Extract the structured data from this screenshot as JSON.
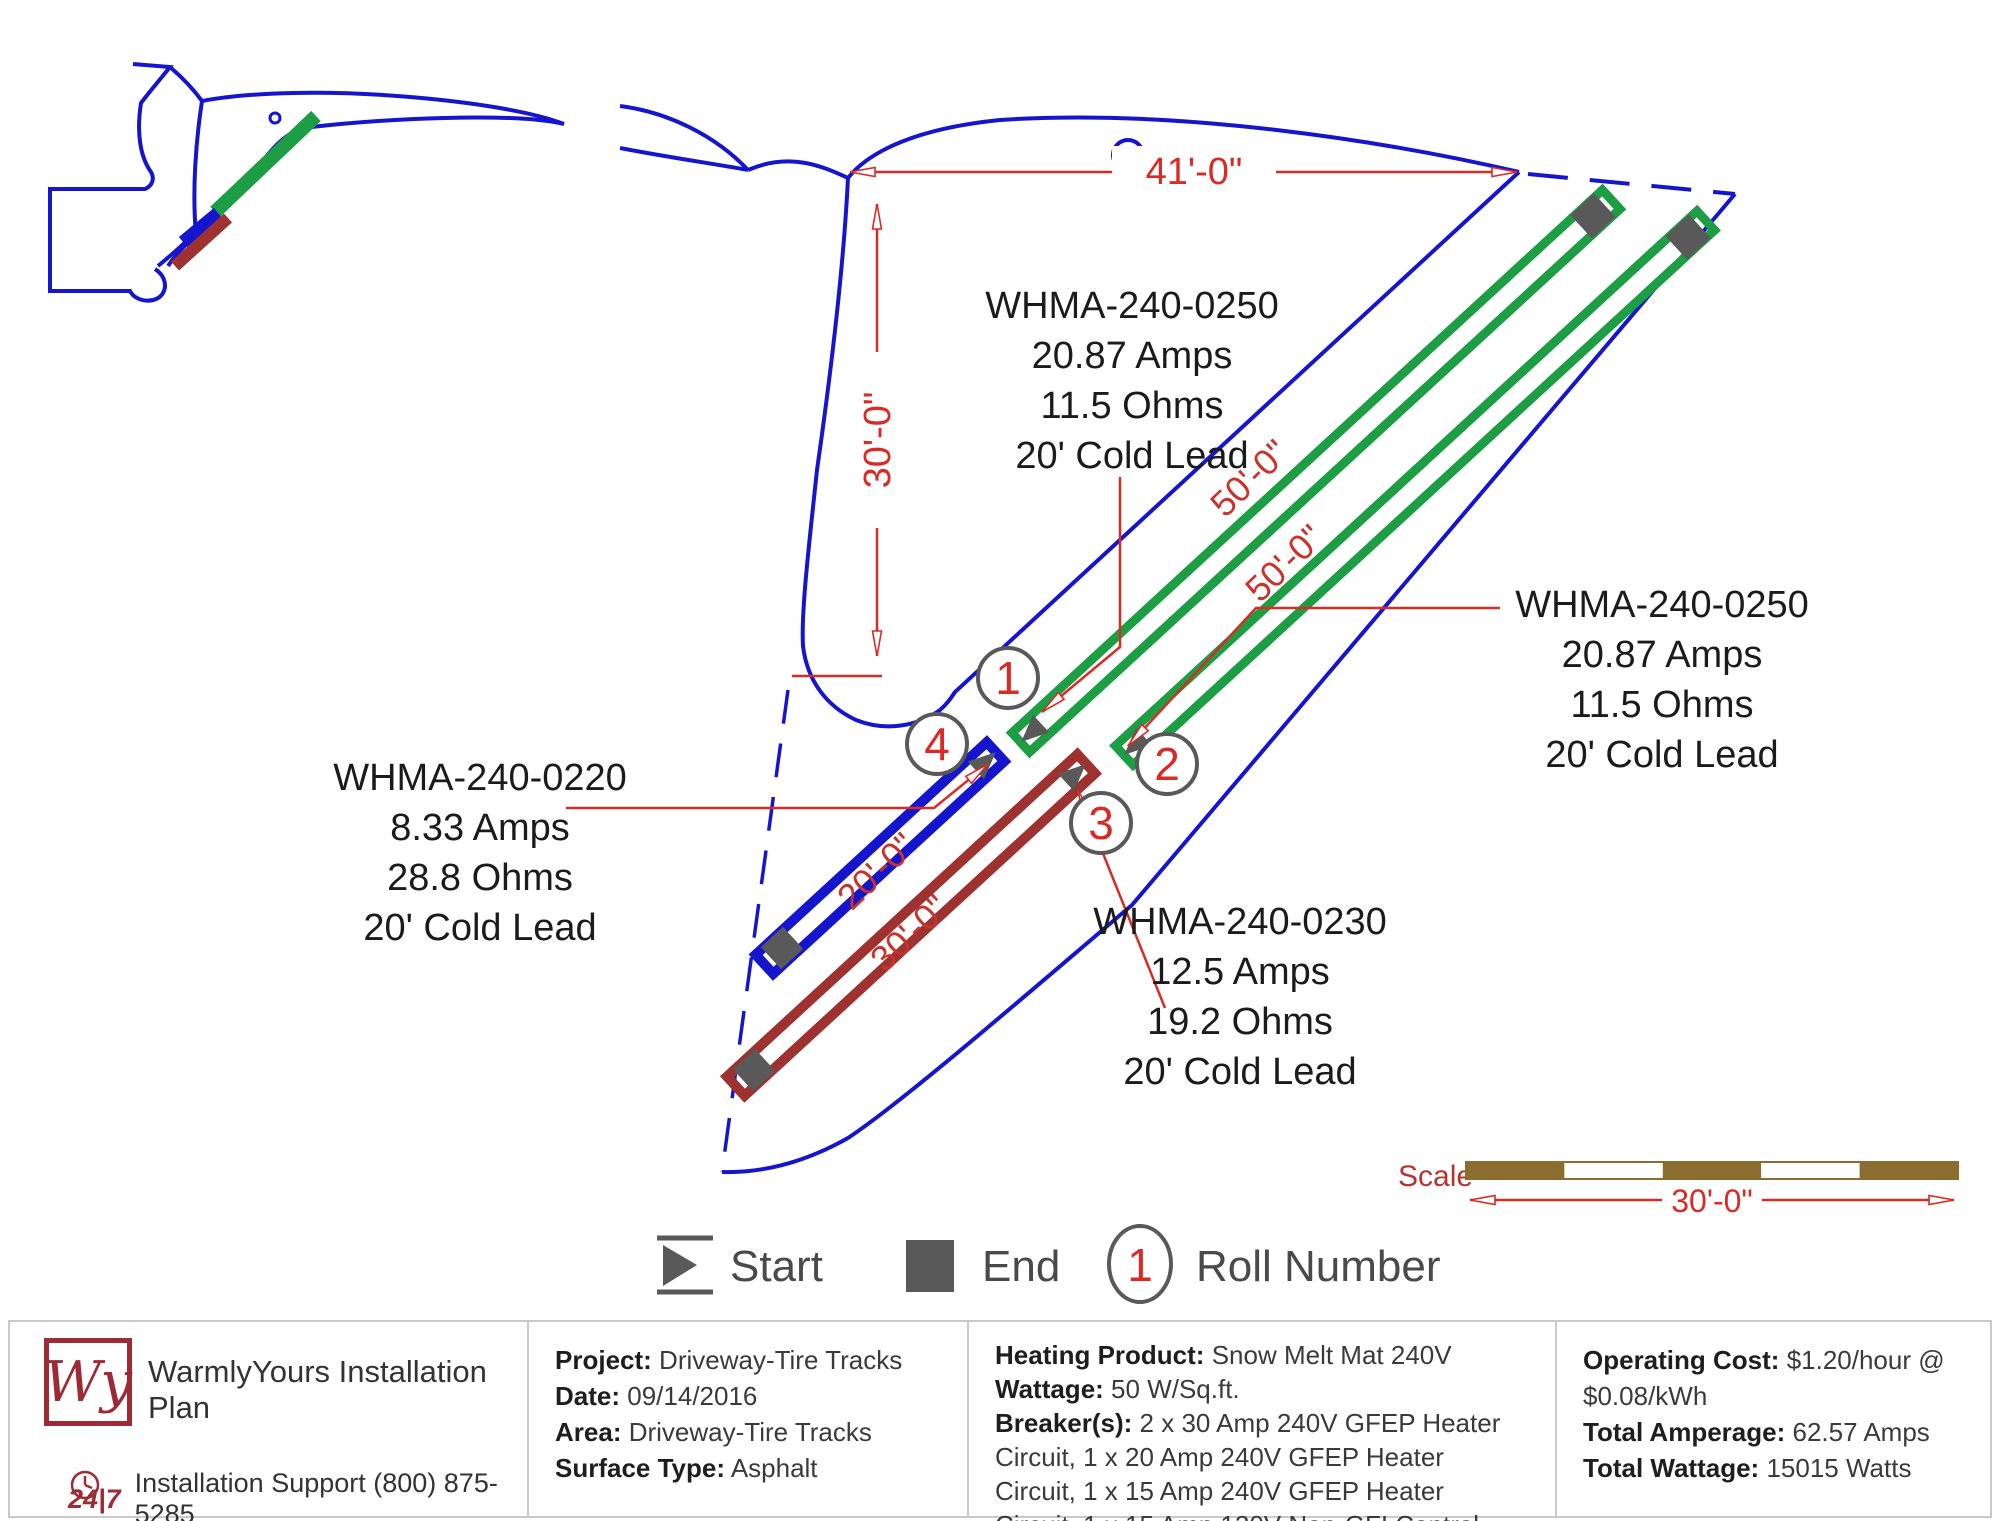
{
  "colors": {
    "boundary_blue": "#1515cd",
    "mat_green": "#1e9e44",
    "mat_dark_red": "#9e3231",
    "annotation_red": "#d92b25",
    "rotated_dim_red": "#c8332c",
    "marker_gray": "#595959",
    "legend_text_gray": "#4a4a4a",
    "scale_bar_brown": "#8a6d2f",
    "logo_red": "#9c2b35"
  },
  "plan": {
    "dimensions": {
      "top_width": "41'-0\"",
      "left_height": "30'-0\"",
      "scale_length": "30'-0\""
    },
    "scale_label": "Scale",
    "rolls": [
      {
        "number": "1",
        "length": "50'-0\"",
        "model": "WHMA-240-0250",
        "amps": "20.87  Amps",
        "ohms": "11.5 Ohms",
        "lead": "20' Cold Lead"
      },
      {
        "number": "2",
        "length": "50'-0\"",
        "model": "WHMA-240-0250",
        "amps": "20.87  Amps",
        "ohms": "11.5 Ohms",
        "lead": "20' Cold Lead"
      },
      {
        "number": "3",
        "length": "30'-0\"",
        "model": "WHMA-240-0230",
        "amps": "12.5  Amps",
        "ohms": "19.2 Ohms",
        "lead": "20' Cold Lead"
      },
      {
        "number": "4",
        "length": "20'-0\"",
        "model": "WHMA-240-0220",
        "amps": "8.33  Amps",
        "ohms": "28.8 Ohms",
        "lead": "20' Cold Lead"
      }
    ],
    "legend": {
      "start": "Start",
      "end": "End",
      "roll_number": "Roll Number",
      "roll_example": "1"
    }
  },
  "footer": {
    "brand": {
      "logo_monogram": "Wy",
      "title": "WarmlyYours Installation Plan",
      "badge": "24|7",
      "support": "Installation Support (800) 875-5285"
    },
    "project": {
      "project_label": "Project:",
      "project_value": "Driveway-Tire Tracks",
      "date_label": "Date:",
      "date_value": "09/14/2016",
      "area_label": "Area:",
      "area_value": "Driveway-Tire Tracks",
      "surface_label": "Surface Type:",
      "surface_value": "Asphalt"
    },
    "product": {
      "heating_label": "Heating Product:",
      "heating_value": "Snow Melt Mat 240V",
      "wattage_label": "Wattage:",
      "wattage_value": "50 W/Sq.ft.",
      "breakers_label": "Breaker(s):",
      "breakers_value": "2 x 30 Amp 240V GFEP Heater Circuit, 1 x 20 Amp 240V GFEP Heater Circuit, 1 x 15 Amp 240V GFEP Heater Circuit, 1 x 15 Amp 120V Non-GFI Control Circuit"
    },
    "totals": {
      "cost_label": "Operating Cost:",
      "cost_value": "$1.20/hour @ $0.08/kWh",
      "amperage_label": "Total Amperage:",
      "amperage_value": "62.57 Amps",
      "wattage_label": "Total Wattage:",
      "wattage_value": "15015 Watts"
    }
  }
}
